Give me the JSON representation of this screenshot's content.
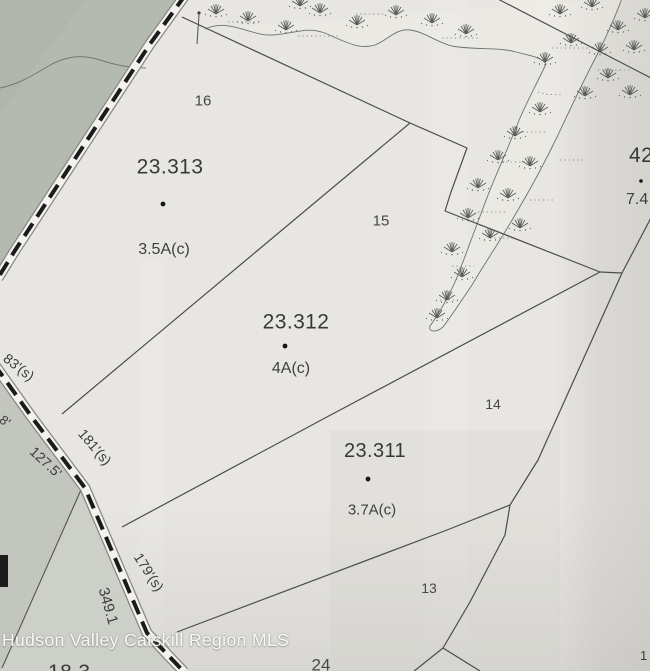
{
  "map": {
    "watermark": "Hudson Valley Catskill Region MLS",
    "parcels": [
      {
        "tax_id": "23.313",
        "lot": "16",
        "acreage": "3.5A(c)"
      },
      {
        "tax_id": "23.312",
        "lot": "15",
        "acreage": "4A(c)"
      },
      {
        "tax_id": "23.311",
        "lot": "14",
        "acreage": "3.7A(c)"
      },
      {
        "tax_id": "42",
        "lot": "",
        "acreage": "7.4"
      },
      {
        "tax_id": "",
        "lot": "13",
        "acreage": ""
      },
      {
        "tax_id": "",
        "lot": "24",
        "acreage": ""
      }
    ],
    "road_dimensions": [
      {
        "text": "83'(s)"
      },
      {
        "text": "8'"
      },
      {
        "text": "127.5'"
      },
      {
        "text": "181'(s)"
      },
      {
        "text": "179'(s)"
      },
      {
        "text": "349.1"
      }
    ],
    "edge_fragments": [
      {
        "text": "1"
      },
      {
        "text": "18.3"
      }
    ],
    "colors": {
      "paper": "#e8e6e2",
      "terrain_dark": "#b5bab1",
      "terrain_mid": "#c2c6be",
      "terrain_light_strip": "#ccd0c8",
      "boundary_line": "#4c4c4c",
      "road_dash": "#1b1b1b",
      "road_fill": "#f3f2ee",
      "marsh_symbol": "#5a5f5a",
      "watermark_text": "#fdfdfc"
    }
  }
}
